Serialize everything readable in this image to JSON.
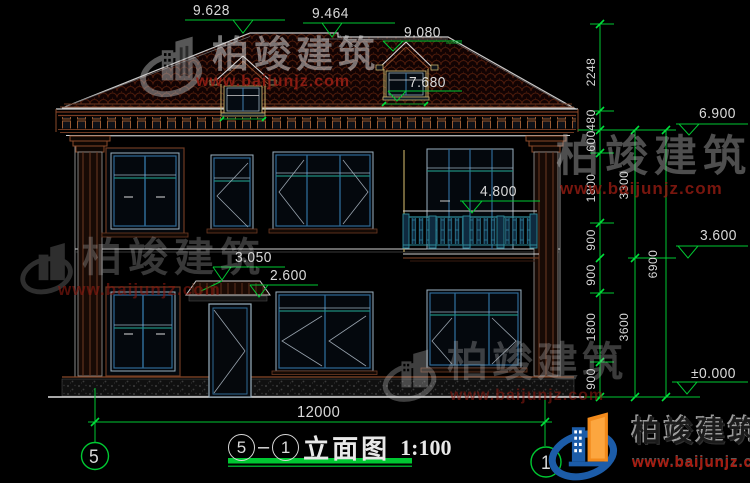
{
  "watermark": {
    "brand": "柏竣建筑",
    "url": "www.baijunjz.com"
  },
  "title": {
    "axis_from": "5",
    "separator": "–",
    "axis_to": "1",
    "name": "立面图",
    "scale": "1:100"
  },
  "axes": {
    "left": "5",
    "right": "1"
  },
  "dims": {
    "overall": "12000",
    "top": [
      "9.628",
      "9.464",
      "9.080",
      "7.680"
    ],
    "mid": [
      "4.800",
      "3.050",
      "2.600"
    ],
    "right_levels": [
      "6.900",
      "3.600",
      "±0.000"
    ],
    "chain1": [
      "2248",
      "480",
      "600",
      "1800",
      "900",
      "900",
      "1800",
      "900"
    ],
    "chain2": [
      "3300",
      "3600"
    ],
    "chain3": [
      "6900"
    ]
  },
  "colors": {
    "dim_green": "#00c832",
    "text": "#d9d9d9",
    "url_red": "#8c1f12",
    "frame_blue": "#2e6a96",
    "sash_teal": "#1f8a7c",
    "trim_brown": "#6e3a22"
  }
}
